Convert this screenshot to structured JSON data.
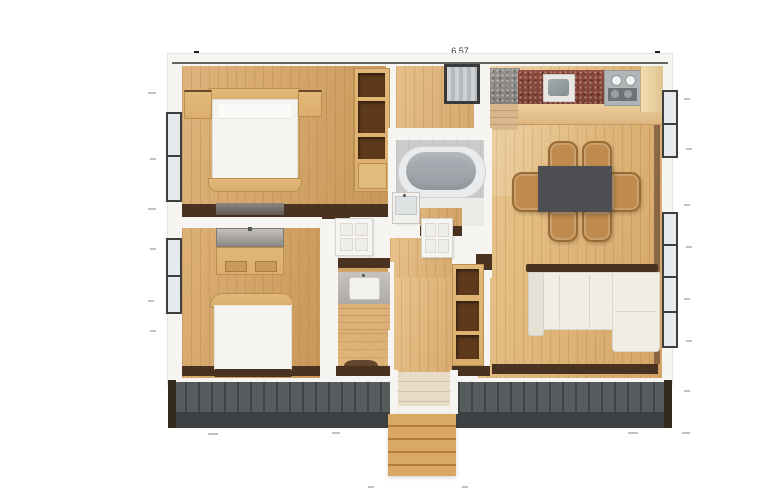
{
  "title": "apartment-floor-plan-render",
  "annotations": {
    "top_dimension": "6.57"
  },
  "colors": {
    "wall": "#f6f5f2",
    "wall_line": "#4f4a44",
    "trim_dark": "#4a3220",
    "furniture_wood": "#dcae6d",
    "shelf_dark": "#5e3a1d",
    "granite_red": "#8a493c",
    "granite_gray": "#8f8d89",
    "appliance_gray": "#aab0b3",
    "table_dark": "#4c4e51",
    "chair_wood": "#bf8b4f",
    "sofa_cream": "#efede4",
    "tub_gray": "#9aa1a6",
    "tile_gray": "#c9cccb",
    "deck_gray": "#565b5e",
    "deck_fascia": "#3d4144",
    "step_wood": "#d9a865",
    "window_frame": "#3e3e3e",
    "glass": "#e7eaec",
    "mattress_white": "#f5f4f1"
  },
  "rooms": [
    {
      "id": "bedroom-1",
      "furniture": [
        "double-bed",
        "nightstand-left",
        "nightstand-right",
        "dark-dresser",
        "closet-shelving"
      ]
    },
    {
      "id": "hallway-top",
      "furniture": [
        "refrigerator"
      ]
    },
    {
      "id": "kitchen-dining",
      "furniture": [
        "corner-counter-gray",
        "countertop-red-granite",
        "kitchen-sink",
        "stove",
        "tall-cabinet",
        "corner-steps",
        "dining-table",
        "chair-x6"
      ]
    },
    {
      "id": "bathroom",
      "furniture": [
        "bathtub",
        "sink-vanity"
      ]
    },
    {
      "id": "hallway-middle",
      "furniture": [
        "panel-door-left",
        "panel-door-right"
      ]
    },
    {
      "id": "bedroom-2",
      "furniture": [
        "gray-dresser",
        "desk",
        "double-bed"
      ]
    },
    {
      "id": "washroom",
      "furniture": [
        "sink-counter",
        "wood-shelf",
        "toilet"
      ]
    },
    {
      "id": "entry",
      "furniture": [
        "shelving-unit",
        "interior-steps"
      ]
    },
    {
      "id": "living-room",
      "furniture": [
        "sectional-sofa"
      ]
    },
    {
      "id": "deck",
      "furniture": [
        "outdoor-steps",
        "corner-posts"
      ]
    }
  ]
}
